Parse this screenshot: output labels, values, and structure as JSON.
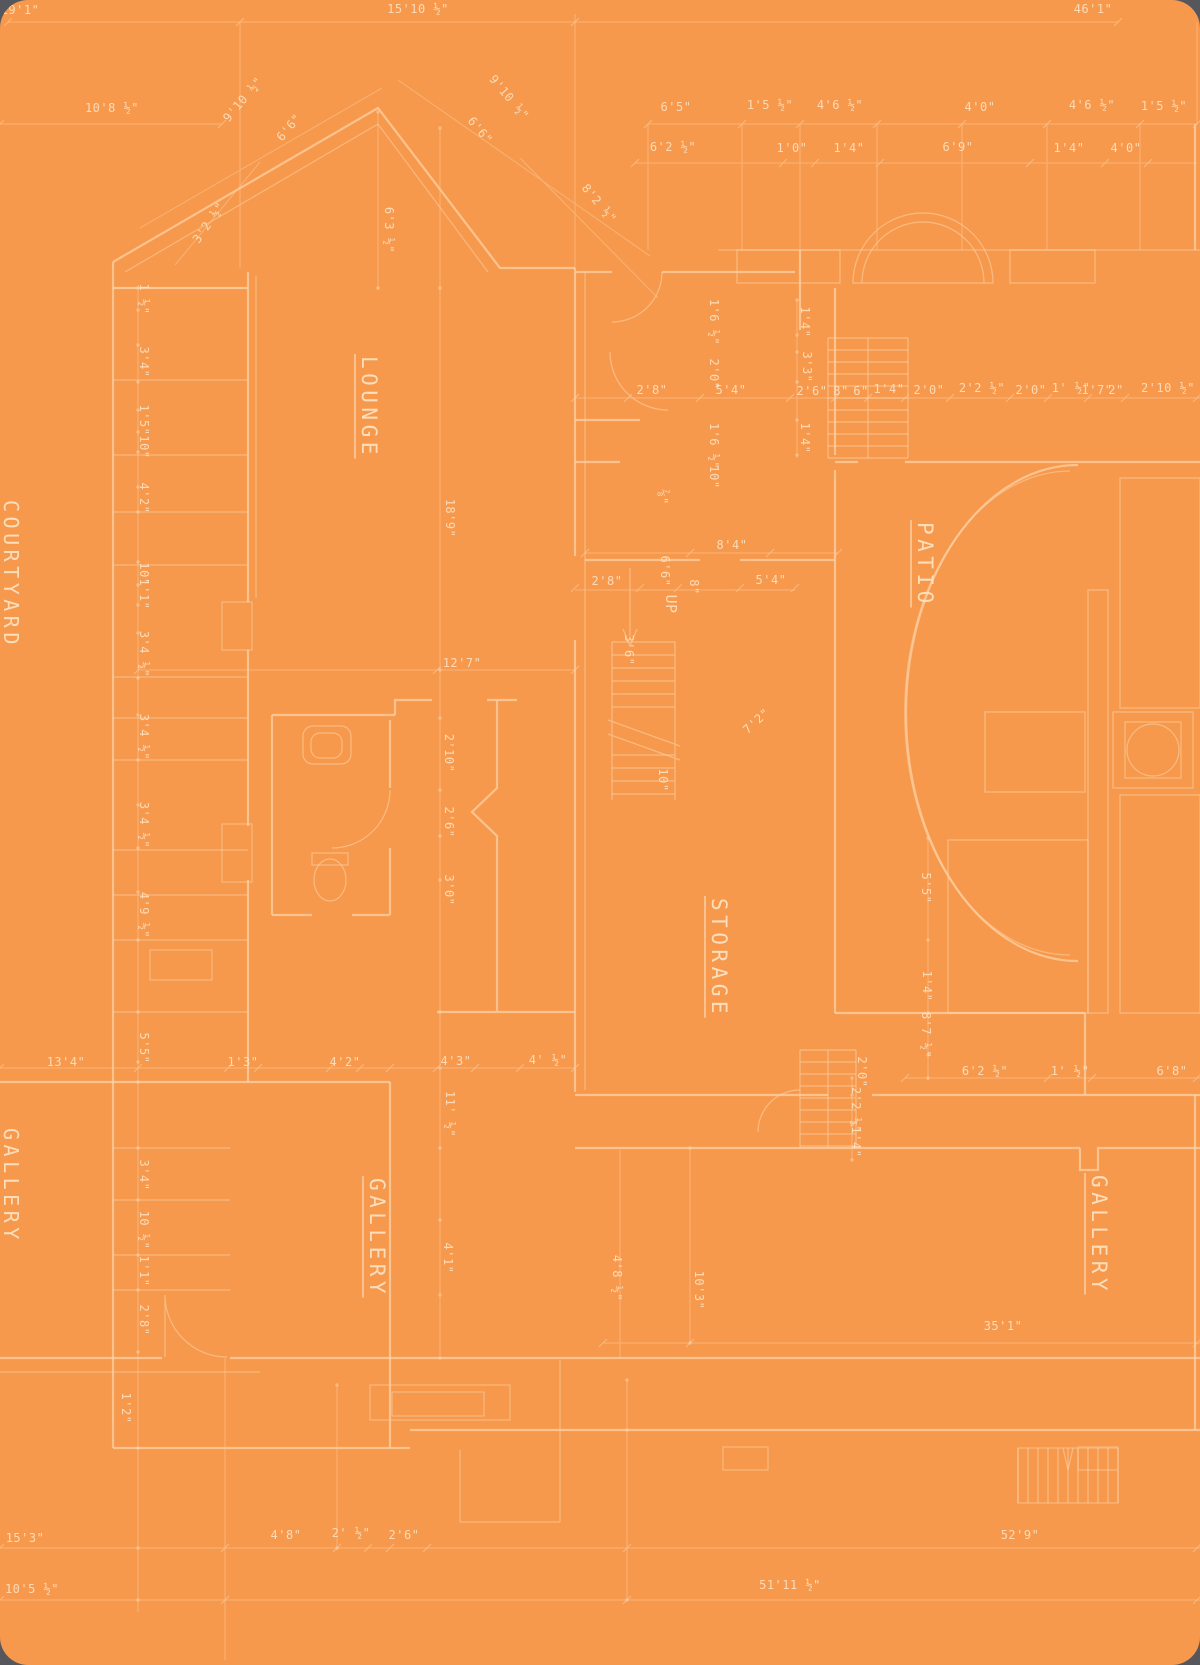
{
  "page": {
    "background": "#56575c"
  },
  "sheet": {
    "background": "#f6994d",
    "line_color": "#fdd2a6",
    "text_color": "#fee3c4"
  },
  "plan": {
    "rooms": [
      {
        "label": "COURTYARD",
        "x": 4,
        "y": 500,
        "rotate": 90,
        "size": 20
      },
      {
        "label": "LOUNGE",
        "x": 362,
        "y": 356,
        "rotate": 90,
        "size": 21
      },
      {
        "label": "PATIO",
        "x": 918,
        "y": 522,
        "rotate": 90,
        "size": 21
      },
      {
        "label": "STORAGE",
        "x": 712,
        "y": 898,
        "rotate": 90,
        "size": 21
      },
      {
        "label": "GALLERY",
        "x": 4,
        "y": 1128,
        "rotate": 90,
        "size": 20
      },
      {
        "label": "GALLERY",
        "x": 370,
        "y": 1178,
        "rotate": 90,
        "size": 21
      },
      {
        "label": "GALLERY",
        "x": 1092,
        "y": 1175,
        "rotate": 90,
        "size": 21
      }
    ],
    "stair_label": {
      "text": "UP",
      "x": 666,
      "y": 604,
      "r": 90,
      "s": 15
    },
    "dimensions": [
      {
        "text": "19'1\"",
        "x": 20,
        "y": 14
      },
      {
        "text": "15'10 ½\"",
        "x": 418,
        "y": 13
      },
      {
        "text": "46'1\"",
        "x": 1093,
        "y": 13
      },
      {
        "text": "10'8 ½\"",
        "x": 112,
        "y": 112
      },
      {
        "text": "9'10 ½\"",
        "x": 246,
        "y": 102,
        "r": -50
      },
      {
        "text": "6'6\"",
        "x": 292,
        "y": 130,
        "r": -50
      },
      {
        "text": "9'10 ½\"",
        "x": 506,
        "y": 100,
        "r": 50
      },
      {
        "text": "6'6\"",
        "x": 477,
        "y": 133,
        "r": 50
      },
      {
        "text": "3'2 ½\"",
        "x": 212,
        "y": 225,
        "r": -55
      },
      {
        "text": "6'3 ½\"",
        "x": 385,
        "y": 230,
        "r": 90
      },
      {
        "text": "8'2 ½\"",
        "x": 596,
        "y": 206,
        "r": 50
      },
      {
        "text": "6'5\"",
        "x": 676,
        "y": 111
      },
      {
        "text": "1'5 ½\"",
        "x": 770,
        "y": 109
      },
      {
        "text": "4'6 ½\"",
        "x": 840,
        "y": 109
      },
      {
        "text": "4'0\"",
        "x": 980,
        "y": 111
      },
      {
        "text": "4'6 ½\"",
        "x": 1092,
        "y": 109
      },
      {
        "text": "1'5 ½\"",
        "x": 1164,
        "y": 110
      },
      {
        "text": "6'2 ½\"",
        "x": 673,
        "y": 151
      },
      {
        "text": "1'0\"",
        "x": 792,
        "y": 152
      },
      {
        "text": "1'4\"",
        "x": 849,
        "y": 152
      },
      {
        "text": "6'9\"",
        "x": 958,
        "y": 151
      },
      {
        "text": "1'4\"",
        "x": 1069,
        "y": 152
      },
      {
        "text": "4'0\"",
        "x": 1126,
        "y": 152
      },
      {
        "text": "1 ½\"",
        "x": 140,
        "y": 299,
        "r": 90
      },
      {
        "text": "3'4\"",
        "x": 140,
        "y": 362,
        "r": 90
      },
      {
        "text": "1'5\"",
        "x": 140,
        "y": 420,
        "r": 90
      },
      {
        "text": "10\"",
        "x": 140,
        "y": 447,
        "r": 90
      },
      {
        "text": "4'2\"",
        "x": 140,
        "y": 498,
        "r": 90
      },
      {
        "text": "10\"",
        "x": 140,
        "y": 574,
        "r": 90
      },
      {
        "text": "1'1\"",
        "x": 140,
        "y": 594,
        "r": 90
      },
      {
        "text": "3'4 ½\"",
        "x": 140,
        "y": 654,
        "r": 90
      },
      {
        "text": "3'4 ½\"",
        "x": 140,
        "y": 737,
        "r": 90
      },
      {
        "text": "3'4 ½\"",
        "x": 140,
        "y": 825,
        "r": 90
      },
      {
        "text": "4'9 ½\"",
        "x": 140,
        "y": 915,
        "r": 90
      },
      {
        "text": "5'5\"",
        "x": 140,
        "y": 1048,
        "r": 90
      },
      {
        "text": "3'4\"",
        "x": 140,
        "y": 1175,
        "r": 90
      },
      {
        "text": "10 ½\"",
        "x": 140,
        "y": 1230,
        "r": 90
      },
      {
        "text": "1'1\"",
        "x": 140,
        "y": 1271,
        "r": 90
      },
      {
        "text": "2'8\"",
        "x": 140,
        "y": 1320,
        "r": 90
      },
      {
        "text": "1'2\"",
        "x": 122,
        "y": 1408,
        "r": 90
      },
      {
        "text": "13'4\"",
        "x": 66,
        "y": 1066
      },
      {
        "text": "1'3\"",
        "x": 243,
        "y": 1066
      },
      {
        "text": "4'2\"",
        "x": 345,
        "y": 1066
      },
      {
        "text": "4'3\"",
        "x": 456,
        "y": 1065
      },
      {
        "text": "4' ½\"",
        "x": 548,
        "y": 1064
      },
      {
        "text": "11' ½\"",
        "x": 446,
        "y": 1114,
        "r": 90
      },
      {
        "text": "4'1\"",
        "x": 444,
        "y": 1258,
        "r": 90
      },
      {
        "text": "4'8 ½\"",
        "x": 613,
        "y": 1278,
        "r": 90
      },
      {
        "text": "18'9\"",
        "x": 446,
        "y": 518,
        "r": 90
      },
      {
        "text": "12'7\"",
        "x": 462,
        "y": 667
      },
      {
        "text": "2'10\"",
        "x": 445,
        "y": 753,
        "r": 90
      },
      {
        "text": "2'6\"",
        "x": 445,
        "y": 822,
        "r": 90
      },
      {
        "text": "3'0\"",
        "x": 445,
        "y": 890,
        "r": 90
      },
      {
        "text": "1'6 ½\"",
        "x": 710,
        "y": 322,
        "r": 90
      },
      {
        "text": "2'0\"",
        "x": 710,
        "y": 374,
        "r": 90
      },
      {
        "text": "2'8\"",
        "x": 652,
        "y": 394
      },
      {
        "text": "5'4\"",
        "x": 731,
        "y": 394
      },
      {
        "text": "2'6\"",
        "x": 812,
        "y": 395
      },
      {
        "text": "8\"",
        "x": 841,
        "y": 395
      },
      {
        "text": "6\"",
        "x": 861,
        "y": 395
      },
      {
        "text": "1'4\"",
        "x": 889,
        "y": 393
      },
      {
        "text": "2'0\"",
        "x": 929,
        "y": 394
      },
      {
        "text": "2'2 ½\"",
        "x": 982,
        "y": 392
      },
      {
        "text": "2'0\"",
        "x": 1031,
        "y": 394
      },
      {
        "text": "1' ½\"",
        "x": 1071,
        "y": 392
      },
      {
        "text": "1'7\"",
        "x": 1097,
        "y": 394
      },
      {
        "text": "2\"",
        "x": 1116,
        "y": 394
      },
      {
        "text": "2'10 ½\"",
        "x": 1168,
        "y": 392
      },
      {
        "text": "1'4\"",
        "x": 801,
        "y": 322,
        "r": 90
      },
      {
        "text": "3'3\"",
        "x": 803,
        "y": 367,
        "r": 90
      },
      {
        "text": "1'4\"",
        "x": 801,
        "y": 438,
        "r": 90
      },
      {
        "text": "1'6 ½\"",
        "x": 710,
        "y": 446,
        "r": 90
      },
      {
        "text": "10\"",
        "x": 710,
        "y": 477,
        "r": 90
      },
      {
        "text": "⅞\"",
        "x": 659,
        "y": 497,
        "r": 90
      },
      {
        "text": "8'4\"",
        "x": 732,
        "y": 549
      },
      {
        "text": "2'8\"",
        "x": 607,
        "y": 585
      },
      {
        "text": "6'6\"",
        "x": 661,
        "y": 571,
        "r": 90
      },
      {
        "text": "8\"",
        "x": 690,
        "y": 587,
        "r": 90
      },
      {
        "text": "5'4\"",
        "x": 771,
        "y": 584
      },
      {
        "text": "3'6\"",
        "x": 625,
        "y": 650,
        "r": 90
      },
      {
        "text": "7'2\"",
        "x": 759,
        "y": 724,
        "r": -42
      },
      {
        "text": "10\"",
        "x": 659,
        "y": 780,
        "r": 90
      },
      {
        "text": "5'5\"",
        "x": 922,
        "y": 888,
        "r": 90
      },
      {
        "text": "1'4\"",
        "x": 923,
        "y": 986,
        "r": 90
      },
      {
        "text": "8'7 ½\"",
        "x": 922,
        "y": 1035,
        "r": 90
      },
      {
        "text": "2'0\"",
        "x": 858,
        "y": 1072,
        "r": 90
      },
      {
        "text": "2'2 ½\"",
        "x": 852,
        "y": 1110,
        "r": 90
      },
      {
        "text": "1'4\"",
        "x": 852,
        "y": 1142,
        "r": 90
      },
      {
        "text": "6'2 ½\"",
        "x": 985,
        "y": 1075
      },
      {
        "text": "1' ½\"",
        "x": 1070,
        "y": 1075
      },
      {
        "text": "6'8\"",
        "x": 1172,
        "y": 1075
      },
      {
        "text": "10'3\"",
        "x": 695,
        "y": 1290,
        "r": 90
      },
      {
        "text": "35'1\"",
        "x": 1003,
        "y": 1330
      },
      {
        "text": "52'9\"",
        "x": 1020,
        "y": 1539
      },
      {
        "text": "51'11 ½\"",
        "x": 790,
        "y": 1589
      },
      {
        "text": "15'3\"",
        "x": 25,
        "y": 1542
      },
      {
        "text": "4'8\"",
        "x": 286,
        "y": 1539
      },
      {
        "text": "2' ½\"",
        "x": 351,
        "y": 1537
      },
      {
        "text": "2'6\"",
        "x": 404,
        "y": 1539
      },
      {
        "text": "10'5 ½\"",
        "x": 32,
        "y": 1593
      }
    ]
  }
}
